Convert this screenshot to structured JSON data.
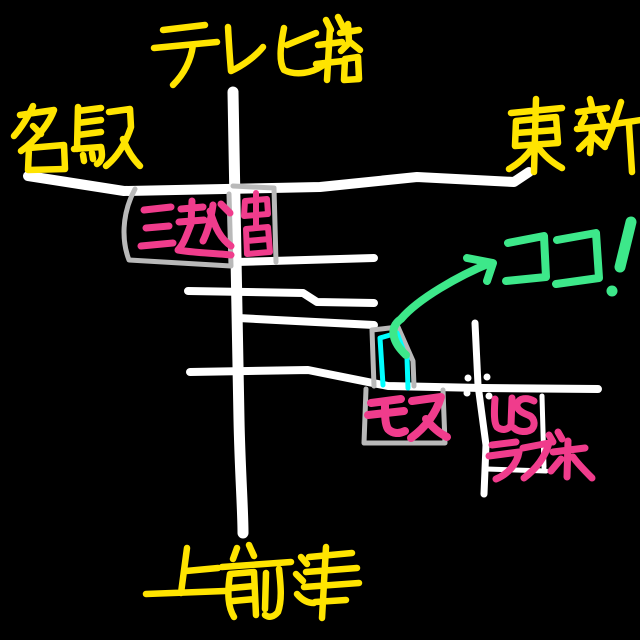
{
  "canvas": {
    "width": 640,
    "height": 640,
    "background": "#000000"
  },
  "palette": {
    "road": "#FFFFFF",
    "box_outline": "#B9B9B9",
    "area_label": "#FFE400",
    "landmark_label": "#F03C8C",
    "highlight": "#3DE88A",
    "target_building": "#00FFFF"
  },
  "labels": {
    "tv_tower": {
      "text": "テレビ塔",
      "color": "#FFE400"
    },
    "meieki": {
      "text": "名駅",
      "color": "#FFE400"
    },
    "toshin": {
      "text": "東新",
      "color": "#FFE400"
    },
    "kamimaezu": {
      "text": "上前津",
      "color": "#FFE400"
    },
    "mitsukoshi": {
      "text": "三越",
      "color": "#F03C8C"
    },
    "chunichi": {
      "text": "中日",
      "color": "#F03C8C"
    },
    "mos": {
      "text": "モス",
      "color": "#F03C8C"
    },
    "us_love_hotel": {
      "line1": "US",
      "line2": "ラブホ",
      "color": "#F03C8C"
    },
    "here": {
      "text": "ココ!",
      "color": "#3DE88A"
    }
  }
}
